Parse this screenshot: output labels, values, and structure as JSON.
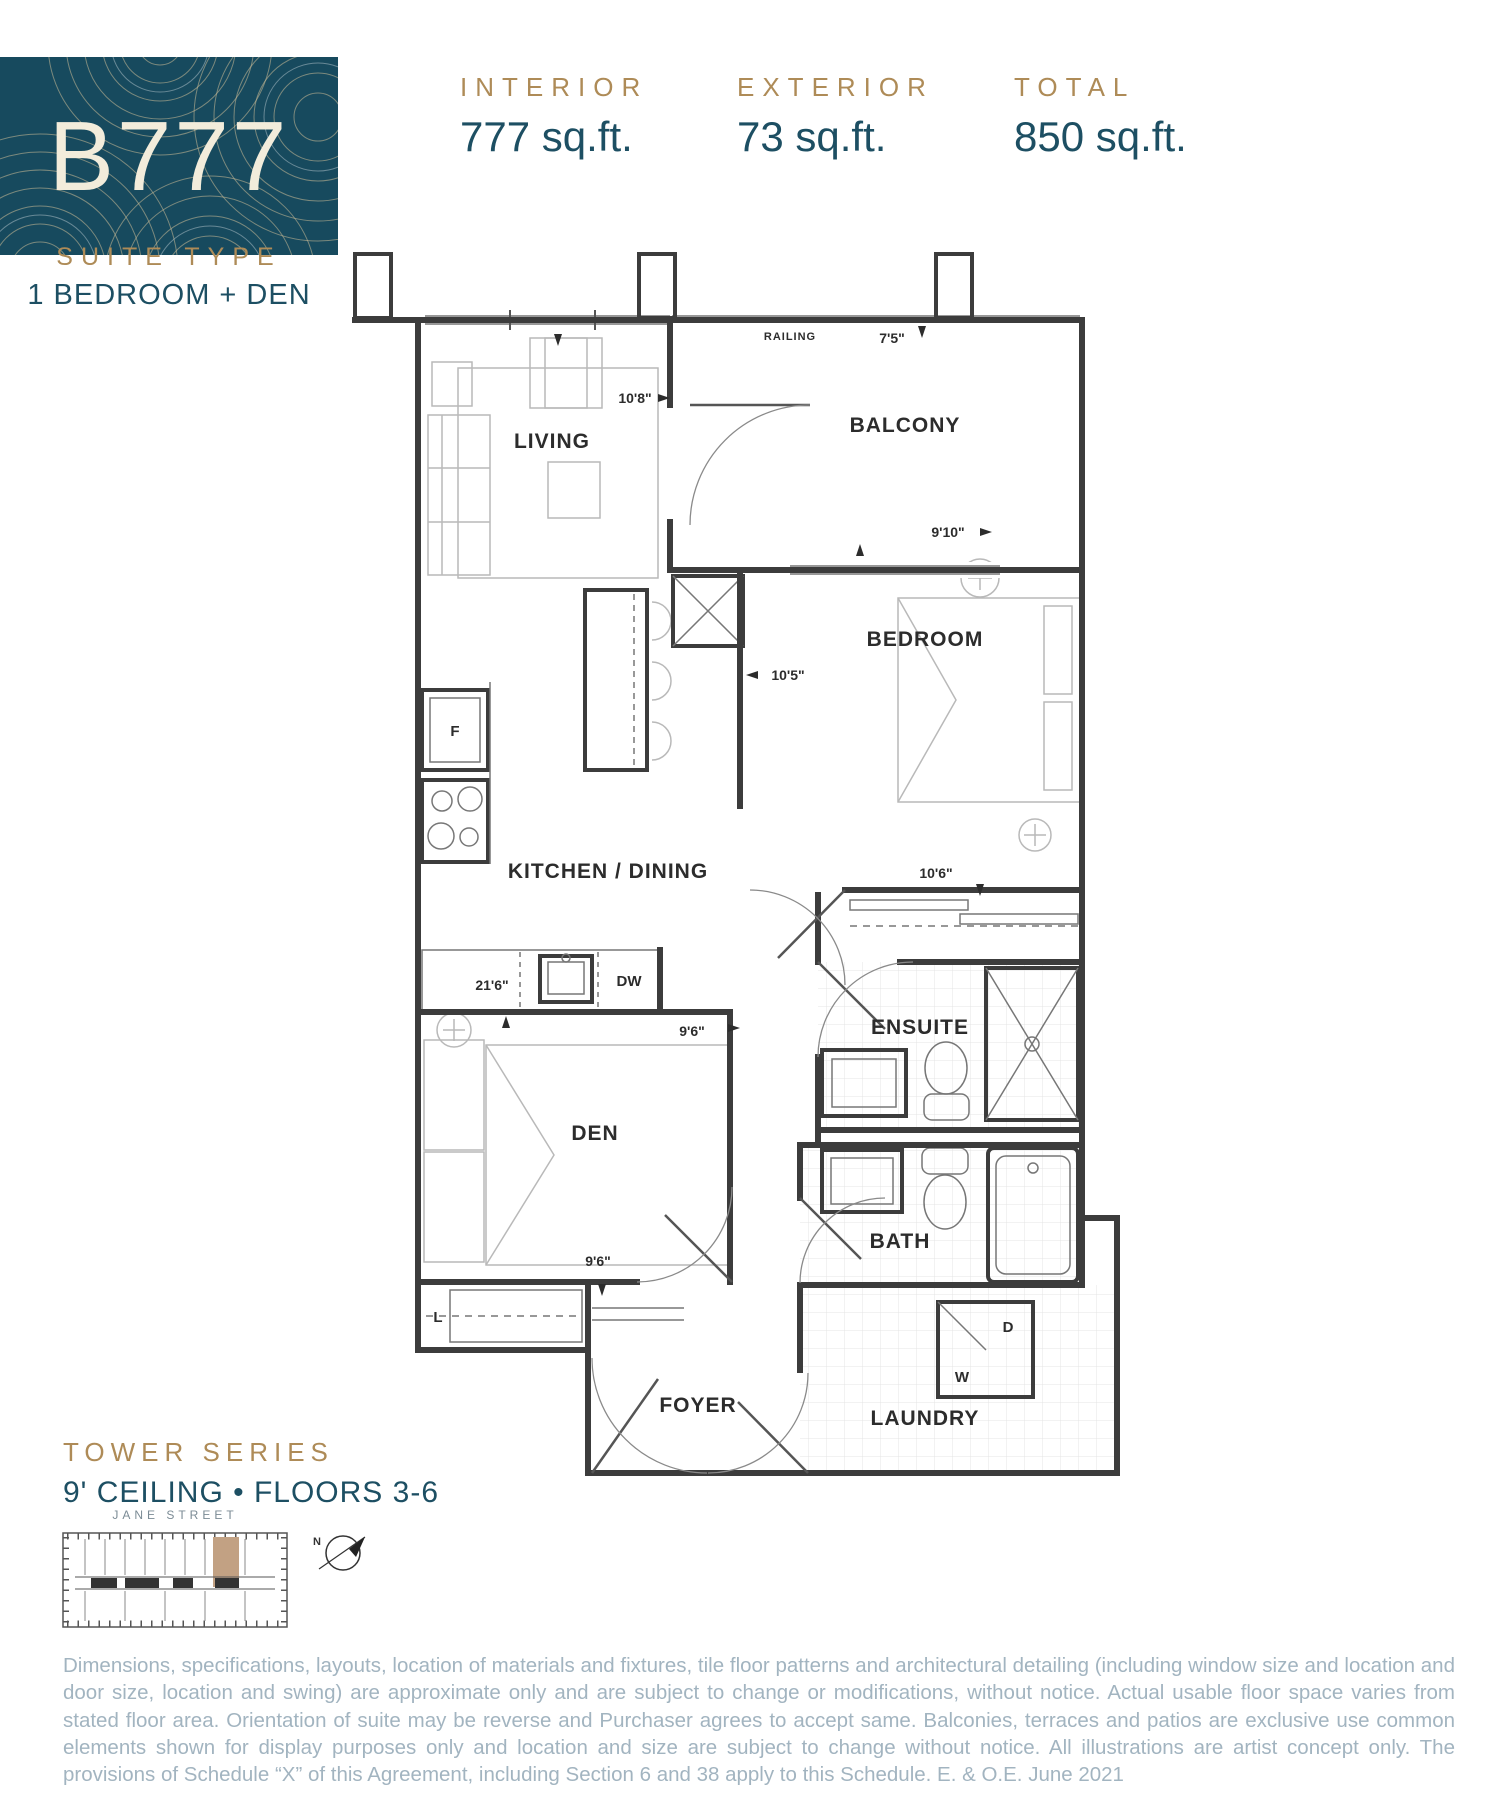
{
  "header": {
    "unit_code": "B777",
    "suite_type_label": "SUITE TYPE",
    "suite_type_value": "1 BEDROOM + DEN",
    "stats": [
      {
        "label": "INTERIOR",
        "value": "777 sq.ft."
      },
      {
        "label": "EXTERIOR",
        "value": "73 sq.ft."
      },
      {
        "label": "TOTAL",
        "value": "850 sq.ft."
      }
    ]
  },
  "floorplan": {
    "rooms": {
      "living": "LIVING",
      "balcony": "BALCONY",
      "bedroom": "BEDROOM",
      "kitchen_dining": "KITCHEN / DINING",
      "den": "DEN",
      "ensuite": "ENSUITE",
      "bath": "BATH",
      "foyer": "FOYER",
      "laundry": "LAUNDRY"
    },
    "dims": {
      "living_width": "10'8\"",
      "balcony_depth": "7'5\"",
      "balcony_width": "9'10\"",
      "bedroom_width": "10'5\"",
      "bedroom_closet": "10'6\"",
      "kitchen_length": "21'6\"",
      "den_width": "9'6\"",
      "den_length": "9'6\""
    },
    "fixtures": {
      "railing": "RAILING",
      "fridge": "F",
      "dishwasher": "DW",
      "linen_closet": "L",
      "dryer": "D",
      "washer": "W"
    }
  },
  "footer": {
    "series_label": "TOWER SERIES",
    "ceiling_floors": "9' CEILING • FLOORS 3-6",
    "street_label": "JANE STREET",
    "compass_north": "N",
    "disclaimer": "Dimensions, specifications, layouts, location of materials and fixtures, tile floor patterns and architectural detailing (including window size and location and door size, location and swing) are approximate only and are subject to change or modifications, without notice. Actual usable floor space varies from stated floor area. Orientation of suite may be reverse and Purchaser agrees to accept same. Balconies, terraces and patios are exclusive use common elements shown for display purposes only and location and size are subject to change without notice. All illustrations are artist concept only. The provisions of Schedule “X” of this Agreement, including Section 6 and 38 apply to this Schedule. E. & O.E. June 2021"
  },
  "colors": {
    "brand_teal": "#174a5e",
    "headline_teal": "#1d4f63",
    "gold": "#ae8b57",
    "logo_text_cream": "#f2ecdb",
    "disclaimer_grey": "#a2b4c0",
    "plan_line": "#3c3c3c",
    "keyplan_highlight": "#c2a183"
  }
}
